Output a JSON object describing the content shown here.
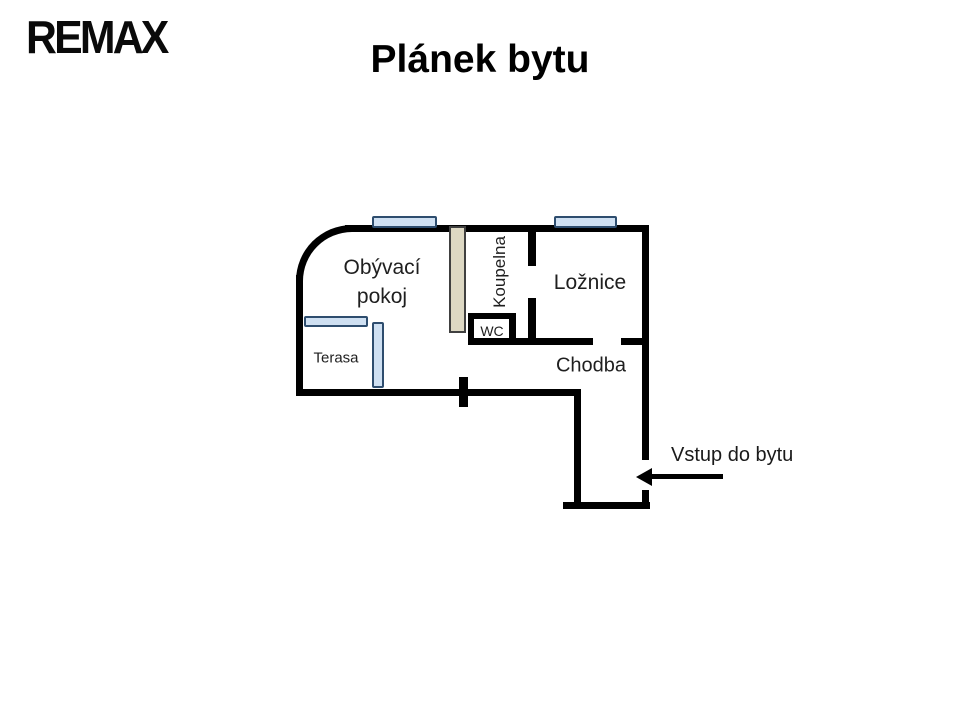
{
  "brand": {
    "logo_text": "REMAX"
  },
  "title": "Plánek bytu",
  "floor_plan": {
    "rooms": [
      {
        "id": "living-room",
        "label": "Obývací pokoj",
        "label_lines": [
          "Obývací",
          "pokoj"
        ]
      },
      {
        "id": "bathroom",
        "label": "Koupelna"
      },
      {
        "id": "bedroom",
        "label": "Ložnice"
      },
      {
        "id": "wc",
        "label": "WC"
      },
      {
        "id": "hallway",
        "label": "Chodba"
      },
      {
        "id": "terrace",
        "label": "Terasa"
      }
    ],
    "entrance": {
      "label": "Vstup do bytu",
      "arrow_direction": "left"
    },
    "windows_count": 4,
    "colors": {
      "wall": "#000000",
      "window_fill": "#cfe0f2",
      "window_border": "#2e4d6e",
      "panel_fill": "#ddd8c3",
      "panel_border": "#404040"
    }
  }
}
